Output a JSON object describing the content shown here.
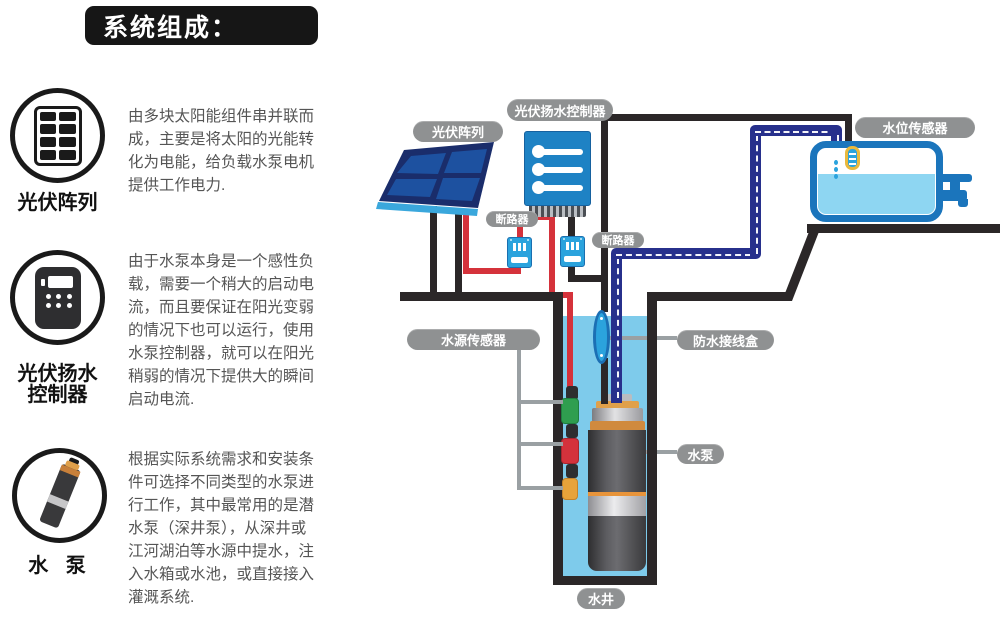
{
  "title": "系统组成：",
  "sidebar": {
    "sections": [
      {
        "icon": "pv-array-icon",
        "label": "光伏阵列",
        "text": "由多块太阳能组件串并联而\n成，主要是将太阳的光能转\n化为电能，给负载水泵电机\n提供工作电力."
      },
      {
        "icon": "controller-icon",
        "label": "光伏扬水\n控制器",
        "text": "由于水泵本身是一个感性负\n载，需要一个稍大的启动电\n流，而且要保证在阳光变弱\n的情况下也可以运行，使用\n水泵控制器，就可以在阳光\n稍弱的情况下提供大的瞬间\n启动电流."
      },
      {
        "icon": "pump-icon",
        "label": "水 泵",
        "text": "根据实际系统需求和安装条\n件可选择不同类型的水泵进\n行工作，其中最常用的是潜\n水泵（深井泵），从深井或\n江河湖泊等水源中提水，注\n入水箱或水池，或直接接入\n灌溉系统."
      }
    ]
  },
  "diagram": {
    "labels": {
      "pv_array": "光伏阵列",
      "controller": "光伏扬水控制器",
      "breaker1": "断路器",
      "breaker2": "断路器",
      "water_level_sensor": "水位传感器",
      "water_source_sensor": "水源传感器",
      "junction_box": "防水接线盒",
      "pump": "水泵",
      "well": "水井"
    },
    "colors": {
      "label_pill": "#8f9192",
      "wire_red": "#d5323b",
      "wire_black": "#2b2728",
      "pipe_navy": "#27308c",
      "water_light": "#7ecbeb",
      "tank_water": "#8ed6f2",
      "tank_border_blue": "#1b75bc",
      "device_blue": "#2ba3dd",
      "controller_blue": "#1e82c4",
      "panel_frame_navy": "#1a2d6b",
      "panel_cell_blue": "#1d51a0",
      "sensor_green": "#2f9e4f",
      "sensor_red": "#d4323c",
      "sensor_yellow": "#e8a33a",
      "float_yellow": "#eab93d",
      "pump_gray": "#4a4a4c",
      "copper": "#d08a3e"
    }
  }
}
